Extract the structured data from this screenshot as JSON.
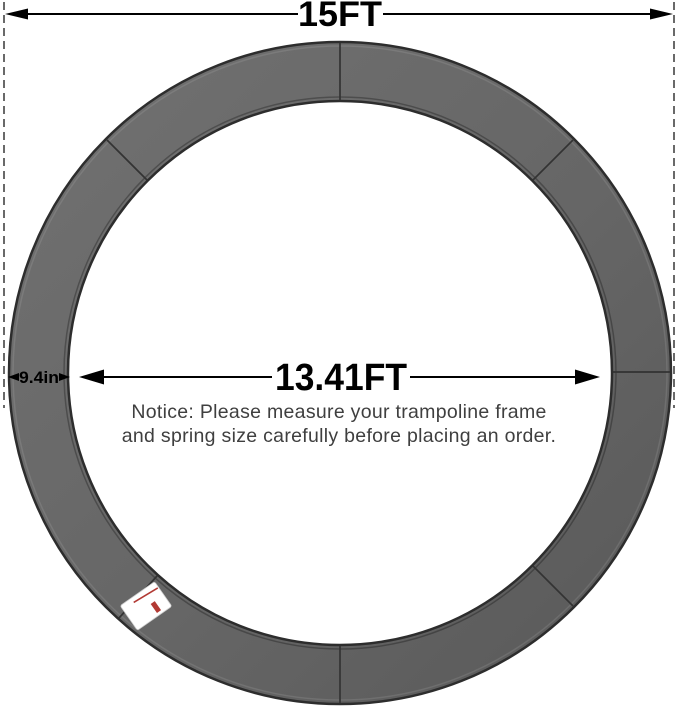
{
  "diagram": {
    "dimensions": {
      "outer": {
        "label": "15FT"
      },
      "inner": {
        "label": "13.41FT"
      },
      "pad_width": {
        "label": "9.4in"
      }
    },
    "notice": {
      "line1": "Notice: Please measure your trampoline frame",
      "line2": "and spring size carefully before placing an order."
    },
    "colors": {
      "pad_fill_light": "#717171",
      "pad_fill_mid": "#666666",
      "pad_fill_dark": "#585858",
      "pad_edge": "#2d2d2d",
      "seam": "#333333",
      "dimension_line": "#000000",
      "extension_line": "#444444",
      "notice_text": "#3f3f3f",
      "tag_background": "#ffffff",
      "tag_stripe": "#b23a34"
    },
    "icons": {
      "left_arrowhead": "filled-left-triangle",
      "right_arrowhead": "filled-right-triangle",
      "extension_line": "vertical-dashed-line"
    }
  }
}
